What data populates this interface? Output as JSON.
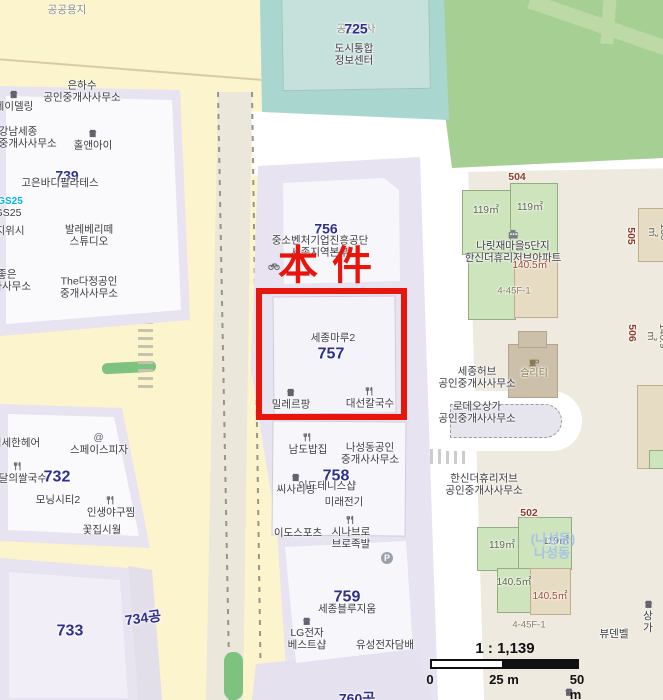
{
  "map": {
    "annotation": {
      "subject_label": "本件"
    },
    "scale": {
      "ratio": "1 : 1,139",
      "tick0": "0",
      "tick25": "25 m",
      "tick50": "50 m"
    },
    "colors": {
      "subject_red": "#e8150c",
      "lot_number_blue": "#2d2f8f",
      "lot_number_red": "#8e3b2b",
      "road_yellow": "#fbf4cd",
      "block_lavender": "#e7e3f0",
      "public_block_teal": "#a9d6cf",
      "park_green": "#a6cf93",
      "ground_beige": "#efeadf"
    },
    "labels": [
      {
        "id": "label-gonggongyongji",
        "text": "공공용지",
        "x": 67,
        "y": 10,
        "cls": "poi poi-faint"
      },
      {
        "id": "label-eunhasu",
        "text": "은하수\n공인중개사사무소",
        "x": 82,
        "y": 92,
        "cls": "poi"
      },
      {
        "id": "label-jeidelling",
        "text": "제이델링",
        "x": 14,
        "y": 101,
        "cls": "poi",
        "icon": "shop"
      },
      {
        "id": "label-gangnamsejong",
        "text": "강남세종\n공인중개사사무소",
        "x": 18,
        "y": 138,
        "cls": "poi"
      },
      {
        "id": "label-holandi",
        "text": "홀앤아이",
        "x": 93,
        "y": 140,
        "cls": "poi",
        "icon": "shop"
      },
      {
        "id": "label-739",
        "text": "739",
        "x": 67,
        "y": 176,
        "cls": "lot-b"
      },
      {
        "id": "label-goeun",
        "text": "고은바디필라테스",
        "x": 60,
        "y": 183,
        "cls": "poi"
      },
      {
        "id": "label-gs25-brand",
        "text": "GS25",
        "x": 10,
        "y": 202,
        "cls": "brand-gs"
      },
      {
        "id": "label-gs25",
        "text": "GS25",
        "x": 8,
        "y": 213,
        "cls": "poi"
      },
      {
        "id": "label-jiwisi",
        "text": "지위시",
        "x": 10,
        "y": 231,
        "cls": "poi"
      },
      {
        "id": "label-ballet",
        "text": "발레베리떼\n스튜디오",
        "x": 89,
        "y": 236,
        "cls": "poi"
      },
      {
        "id": "label-dajoeun",
        "text": "다좋은\n중개사사무소",
        "x": 2,
        "y": 281,
        "cls": "poi"
      },
      {
        "id": "label-thedajeong",
        "text": "The다정공인\n중개사사무소",
        "x": 89,
        "y": 288,
        "cls": "poi"
      },
      {
        "id": "label-725-faint",
        "text": "공공청사",
        "x": 356,
        "y": 29,
        "cls": "poi poi-faint"
      },
      {
        "id": "label-725",
        "text": "725",
        "x": 356,
        "y": 29,
        "cls": "lot-b"
      },
      {
        "id": "label-dosi",
        "text": "도시통합\n정보센터",
        "x": 354,
        "y": 55,
        "cls": "poi"
      },
      {
        "id": "label-756",
        "text": "756",
        "x": 326,
        "y": 229,
        "cls": "lot-b"
      },
      {
        "id": "label-jungso",
        "text": "중소벤처기업진흥공단\n세종지역본부",
        "x": 320,
        "y": 247,
        "cls": "poi"
      },
      {
        "id": "label-bike-rack",
        "text": "",
        "x": 274,
        "y": 266,
        "cls": "poi",
        "icon": "bike"
      },
      {
        "id": "label-sejongmaru2",
        "text": "세종마루2",
        "x": 333,
        "y": 338,
        "cls": "poi"
      },
      {
        "id": "label-757",
        "text": "757",
        "x": 331,
        "y": 355,
        "cls": "lot-b lot-b-lg"
      },
      {
        "id": "label-millereupang",
        "text": "밀레르팡",
        "x": 291,
        "y": 399,
        "cls": "poi",
        "icon": "shop"
      },
      {
        "id": "label-daeseon",
        "text": "대선칼국수",
        "x": 370,
        "y": 398,
        "cls": "poi",
        "icon": "food"
      },
      {
        "id": "label-namdo",
        "text": "남도밥집",
        "x": 308,
        "y": 444,
        "cls": "poi",
        "icon": "food"
      },
      {
        "id": "label-naseongdong-gongin",
        "text": "나성동공인\n중개사사무소",
        "x": 370,
        "y": 454,
        "cls": "poi"
      },
      {
        "id": "label-758",
        "text": "758",
        "x": 336,
        "y": 477,
        "cls": "lot-b lot-b-lg"
      },
      {
        "id": "label-idotennis",
        "text": "이도테니스샵",
        "x": 327,
        "y": 486,
        "cls": "poi"
      },
      {
        "id": "label-ssisariving",
        "text": "씨사리빙",
        "x": 296,
        "y": 484,
        "cls": "poi",
        "icon": "shop"
      },
      {
        "id": "label-mirae",
        "text": "미래전기",
        "x": 344,
        "y": 502,
        "cls": "poi"
      },
      {
        "id": "label-idosports",
        "text": "이도스포츠",
        "x": 298,
        "y": 533,
        "cls": "poi"
      },
      {
        "id": "label-sinabro",
        "text": "시나브로\n브로족발",
        "x": 351,
        "y": 533,
        "cls": "poi",
        "icon": "food"
      },
      {
        "id": "label-parking",
        "text": "",
        "x": 387,
        "y": 558,
        "cls": "poi",
        "icon": "parking"
      },
      {
        "id": "label-759",
        "text": "759",
        "x": 347,
        "y": 598,
        "cls": "lot-b lot-b-lg"
      },
      {
        "id": "label-bluezium",
        "text": "세종블루지움",
        "x": 347,
        "y": 609,
        "cls": "poi"
      },
      {
        "id": "label-lg",
        "text": "LG전자\n베스트샵",
        "x": 307,
        "y": 634,
        "cls": "poi",
        "icon": "shop"
      },
      {
        "id": "label-yuseong",
        "text": "유성전자담배",
        "x": 385,
        "y": 645,
        "cls": "poi"
      },
      {
        "id": "label-760",
        "text": "760공",
        "x": 357,
        "y": 699,
        "cls": "lot-b"
      },
      {
        "id": "label-seomse",
        "text": "섬세한헤어",
        "x": 16,
        "y": 443,
        "cls": "poi"
      },
      {
        "id": "label-spacepizza",
        "text": "스페이스피자",
        "x": 99,
        "y": 444,
        "cls": "poi",
        "icon": "at"
      },
      {
        "id": "label-baedal",
        "text": "배달의쌀국수",
        "x": 18,
        "y": 473,
        "cls": "poi",
        "icon": "food"
      },
      {
        "id": "label-732",
        "text": "732",
        "x": 57,
        "y": 478,
        "cls": "lot-b lot-b-lg"
      },
      {
        "id": "label-morningcity2",
        "text": "모닝시티2",
        "x": 58,
        "y": 500,
        "cls": "poi"
      },
      {
        "id": "label-insaeng",
        "text": "인생야구찜",
        "x": 111,
        "y": 507,
        "cls": "poi",
        "icon": "food"
      },
      {
        "id": "label-kkotjip",
        "text": "꽃집시월",
        "x": 102,
        "y": 530,
        "cls": "poi"
      },
      {
        "id": "label-733",
        "text": "733",
        "x": 70,
        "y": 632,
        "cls": "lot-b lot-b-lg"
      },
      {
        "id": "label-734",
        "text": "734공",
        "x": 143,
        "y": 618,
        "cls": "lot-b",
        "rot": -8
      },
      {
        "id": "label-504",
        "text": "504",
        "x": 517,
        "y": 177,
        "cls": "lot-r"
      },
      {
        "id": "label-area-119-a",
        "text": "119㎡",
        "x": 486,
        "y": 211,
        "cls": "area-g"
      },
      {
        "id": "label-area-119-b",
        "text": "119㎡",
        "x": 530,
        "y": 208,
        "cls": "area-g"
      },
      {
        "id": "label-naritjae",
        "text": "나릿재마을5단지\n한신더휴리저브아파트",
        "x": 513,
        "y": 247,
        "cls": "poi",
        "icon": "apt"
      },
      {
        "id": "label-area-1405-a",
        "text": "140.5㎡",
        "x": 530,
        "y": 266,
        "cls": "area-r"
      },
      {
        "id": "label-addr-445f1-a",
        "text": "4-45F-1",
        "x": 514,
        "y": 291,
        "cls": "addr"
      },
      {
        "id": "label-505",
        "text": "505",
        "x": 631,
        "y": 236,
        "cls": "lot-r",
        "rot": 90
      },
      {
        "id": "label-area-138",
        "text": "138㎡",
        "x": 657,
        "y": 232,
        "cls": "area-g",
        "rot": 90
      },
      {
        "id": "label-sejonghub",
        "text": "세종허브\n공인중개사사무소",
        "x": 477,
        "y": 378,
        "cls": "poi"
      },
      {
        "id": "label-cafe",
        "text": "슬리티",
        "x": 534,
        "y": 369,
        "cls": "cafe-name",
        "icon": "cafe"
      },
      {
        "id": "label-rodeo",
        "text": "로데오상가\n공인중개사사무소",
        "x": 477,
        "y": 413,
        "cls": "poi"
      },
      {
        "id": "label-506",
        "text": "506",
        "x": 632,
        "y": 333,
        "cls": "lot-r",
        "rot": 90
      },
      {
        "id": "label-area-1409",
        "text": "140.9㎡",
        "x": 656,
        "y": 336,
        "cls": "area-g",
        "rot": 90
      },
      {
        "id": "label-hanshin-re",
        "text": "한신더휴리저브\n공인중개사사무소",
        "x": 484,
        "y": 485,
        "cls": "poi"
      },
      {
        "id": "label-502",
        "text": "502",
        "x": 529,
        "y": 513,
        "cls": "lot-r"
      },
      {
        "id": "label-area-119-c",
        "text": "119㎡",
        "x": 502,
        "y": 546,
        "cls": "area-g"
      },
      {
        "id": "label-area-119-d",
        "text": "119㎡",
        "x": 556,
        "y": 542,
        "cls": "area-g"
      },
      {
        "id": "label-naseongdong-paren",
        "text": "(나성동)",
        "x": 553,
        "y": 539,
        "cls": "name-blue"
      },
      {
        "id": "label-naseongdong",
        "text": "나성동",
        "x": 552,
        "y": 553,
        "cls": "name-blue"
      },
      {
        "id": "label-area-1405-b",
        "text": "140.5㎡",
        "x": 514,
        "y": 583,
        "cls": "area-g"
      },
      {
        "id": "label-area-1405-c",
        "text": "140.5㎡",
        "x": 550,
        "y": 597,
        "cls": "area-r"
      },
      {
        "id": "label-addr-445f1-b",
        "text": "4-45F-1",
        "x": 529,
        "y": 625,
        "cls": "addr"
      },
      {
        "id": "label-byudenbel",
        "text": "뷰덴벨",
        "x": 614,
        "y": 634,
        "cls": "poi"
      },
      {
        "id": "label-sangga",
        "text": "상가",
        "x": 648,
        "y": 617,
        "cls": "poi",
        "icon": "shop"
      },
      {
        "id": "label-bottom-shop",
        "text": "",
        "x": 569,
        "y": 692,
        "cls": "poi",
        "icon": "shop"
      }
    ]
  }
}
